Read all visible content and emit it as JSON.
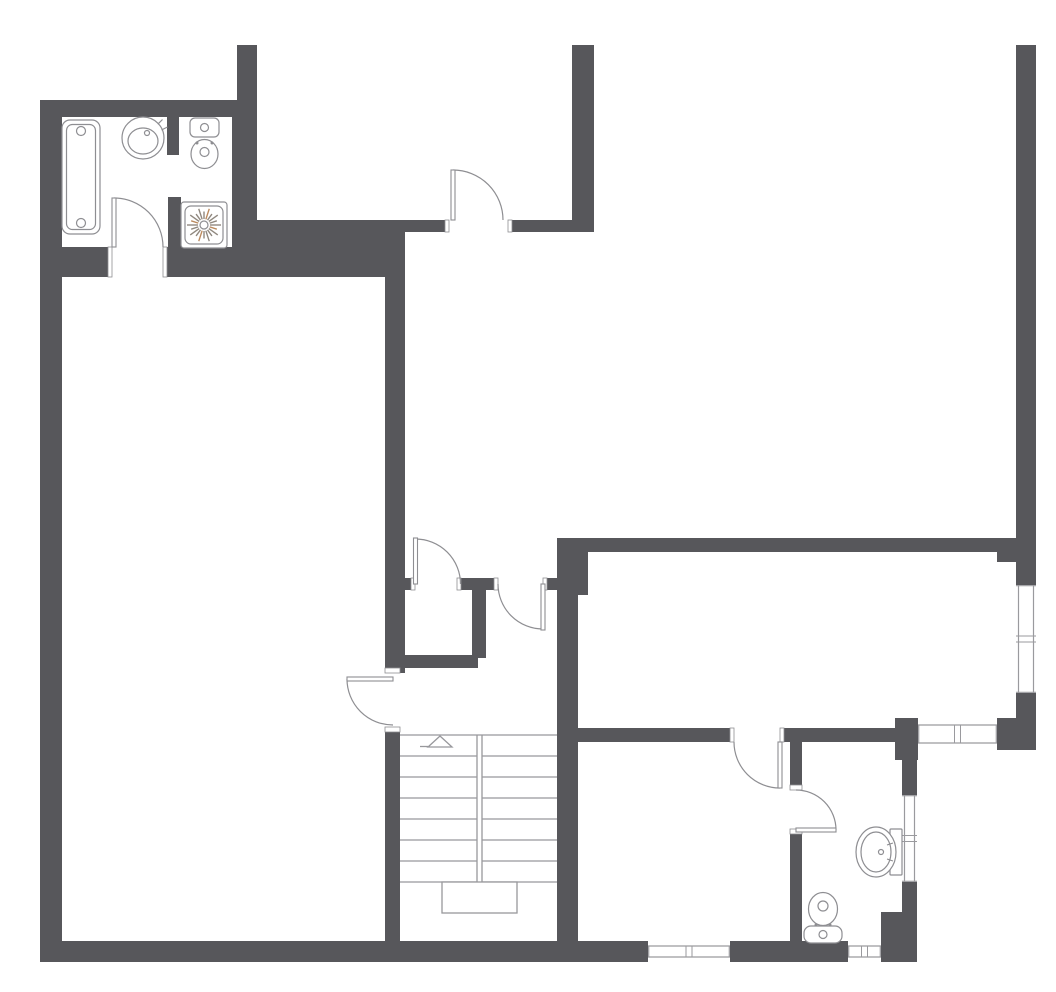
{
  "meta": {
    "type": "architectural-floor-plan",
    "canvas": {
      "w": 1056,
      "h": 992
    },
    "visible_text": []
  },
  "colors": {
    "background": "#ffffff",
    "wall": "#57575b",
    "fixture_stroke": "#8e8e92",
    "stair_stroke": "#98989c",
    "window_frame": "#9a9a9e",
    "shower_ray": "#90887f",
    "shower_ray_warm": "#bb8a5e"
  },
  "walls": [
    [
      40,
      100,
      22,
      858
    ],
    [
      40,
      100,
      217,
      17
    ],
    [
      237,
      45,
      20,
      72
    ],
    [
      232,
      117,
      25,
      160
    ],
    [
      167,
      117,
      12,
      38
    ],
    [
      168,
      197,
      13,
      53
    ],
    [
      40,
      247,
      72,
      30
    ],
    [
      163,
      247,
      69,
      30
    ],
    [
      257,
      220,
      148,
      57
    ],
    [
      405,
      220,
      44,
      12
    ],
    [
      508,
      220,
      64,
      12
    ],
    [
      572,
      45,
      22,
      187
    ],
    [
      385,
      220,
      20,
      453
    ],
    [
      385,
      732,
      15,
      209
    ],
    [
      398,
      578,
      17,
      12
    ],
    [
      461,
      578,
      37,
      12
    ],
    [
      543,
      578,
      14,
      12
    ],
    [
      472,
      590,
      14,
      68
    ],
    [
      398,
      655,
      80,
      13
    ],
    [
      557,
      538,
      21,
      403
    ],
    [
      578,
      552,
      10,
      43
    ],
    [
      563,
      538,
      453,
      14
    ],
    [
      1016,
      45,
      20,
      540
    ],
    [
      997,
      548,
      19,
      14
    ],
    [
      1016,
      693,
      20,
      25
    ],
    [
      997,
      718,
      39,
      32
    ],
    [
      557,
      728,
      177,
      14
    ],
    [
      780,
      728,
      115,
      14
    ],
    [
      895,
      718,
      23,
      42
    ],
    [
      790,
      742,
      12,
      48
    ],
    [
      790,
      829,
      12,
      112
    ],
    [
      902,
      760,
      15,
      35
    ],
    [
      902,
      882,
      15,
      30
    ],
    [
      881,
      912,
      36,
      50
    ],
    [
      40,
      941,
      608,
      21
    ],
    [
      730,
      941,
      118,
      21
    ]
  ],
  "windows": [
    {
      "id": "window-right-wall",
      "x": 1016,
      "y": 585,
      "w": 20,
      "h": 108,
      "orient": "v"
    },
    {
      "id": "window-right-room-bottom",
      "x": 918,
      "y": 722,
      "w": 79,
      "h": 24,
      "orient": "h"
    },
    {
      "id": "window-bathroom-right",
      "x": 902,
      "y": 795,
      "w": 15,
      "h": 87,
      "orient": "v"
    },
    {
      "id": "window-bathroom-bottom",
      "x": 848,
      "y": 943,
      "w": 33,
      "h": 17,
      "orient": "h"
    },
    {
      "id": "window-bedroom-bottom",
      "x": 648,
      "y": 943,
      "w": 82,
      "h": 17,
      "orient": "h"
    }
  ],
  "doors": [
    {
      "id": "door-bathroom-top-left",
      "leaf": [
        112,
        198,
        4,
        49
      ],
      "arc": "M114,198 A49,49 0 0 1 163,247",
      "jambs": [
        [
          108,
          247,
          4,
          30
        ],
        [
          163,
          247,
          4,
          30
        ]
      ]
    },
    {
      "id": "door-top-middle-room",
      "leaf": [
        451,
        170,
        4,
        50
      ],
      "arc": "M453,170 A50,50 0 0 1 503,220",
      "jambs": [
        [
          445,
          220,
          4,
          12
        ],
        [
          508,
          220,
          4,
          12
        ]
      ]
    },
    {
      "id": "door-closet",
      "leaf": [
        413.5,
        538,
        4,
        46
      ],
      "arc": "M415.5,539 A45,45 0 0 1 460.5,584",
      "jambs": [
        [
          411,
          578,
          4,
          12
        ],
        [
          457,
          578,
          4,
          12
        ]
      ]
    },
    {
      "id": "door-stair-passage",
      "leaf": [
        541,
        584,
        4,
        46
      ],
      "arc": "M498,584 A45,45 0 0 0 543,629",
      "jambs": [
        [
          494,
          578,
          4,
          12
        ],
        [
          543,
          578,
          4,
          12
        ]
      ]
    },
    {
      "id": "door-stairs-room",
      "leaf": [
        347,
        677,
        46,
        4
      ],
      "arc": "M347,679 A46,46 0 0 0 393,725",
      "jambs": [
        [
          385,
          668,
          15,
          5
        ],
        [
          385,
          727,
          15,
          5
        ]
      ]
    },
    {
      "id": "door-bedroom",
      "leaf": [
        778,
        742,
        4,
        46
      ],
      "arc": "M734,742 A46,46 0 0 0 780,788",
      "jambs": [
        [
          730,
          728,
          4,
          14
        ],
        [
          780,
          728,
          4,
          14
        ]
      ]
    },
    {
      "id": "door-bathroom-bottom",
      "leaf": [
        796,
        828,
        40,
        4
      ],
      "arc": "M796,790 A40,40 0 0 1 836,830",
      "jambs": [
        [
          790,
          785,
          12,
          5
        ],
        [
          790,
          829,
          12,
          5
        ]
      ]
    }
  ],
  "stairs": {
    "x_left": 400,
    "x_mid1": 477,
    "x_mid2": 482,
    "x_right": 557,
    "y_top": 735,
    "y_bottom": 882,
    "treads": [
      756,
      777,
      798,
      819,
      840,
      861,
      882
    ],
    "landing": {
      "x": 442,
      "y": 882,
      "w": 75,
      "h": 31
    },
    "arrow": {
      "points": "428,747 452,747 440,736",
      "tail": [
        420,
        746.5,
        428,
        746.5
      ]
    }
  },
  "fixtures": [
    {
      "id": "bathtub",
      "type": "bathtub",
      "x": 62,
      "y": 120,
      "w": 38,
      "h": 114,
      "circles": [
        [
          81,
          131,
          4.5
        ],
        [
          81,
          223,
          4.5
        ]
      ]
    },
    {
      "id": "sink-round-top-left",
      "type": "sink-round",
      "cx": 143,
      "cy": 138,
      "r": 21,
      "inner": [
        143,
        141,
        15,
        13
      ],
      "drain": [
        147,
        133,
        2.5
      ],
      "taps": [
        [
          157.8,
          124.2,
          162.5,
          119.5
        ],
        [
          161.5,
          130,
          167.5,
          127
        ]
      ]
    },
    {
      "id": "toilet-top-left",
      "type": "toilet",
      "tank": [
        190,
        118,
        29,
        19,
        5
      ],
      "tank_circle": [
        204.5,
        127.5,
        4
      ],
      "dots": [
        [
          197,
          143
        ],
        [
          212,
          143
        ]
      ],
      "bowl": [
        204.5,
        154,
        13.5,
        14.5
      ],
      "bowl_circle": [
        204.5,
        152,
        4.5
      ]
    },
    {
      "id": "shower-tray",
      "type": "shower",
      "x": 181,
      "y": 202,
      "s": 46,
      "cx": 204,
      "cy": 225,
      "rays": 20
    },
    {
      "id": "toilet-bottom-right",
      "type": "toilet",
      "tank": [
        804,
        926,
        38,
        17,
        7
      ],
      "tank_circle": [
        823,
        934.5,
        4
      ],
      "dots": [
        [
          816,
          925
        ],
        [
          830,
          925
        ]
      ],
      "bowl": [
        823,
        909,
        14.5,
        16.5
      ],
      "bowl_circle": [
        823,
        906,
        5
      ]
    },
    {
      "id": "sink-oval-bottom-right",
      "type": "sink-oval",
      "mount": [
        890,
        829,
        12,
        46
      ],
      "outer": [
        876,
        852,
        20,
        25
      ],
      "inner": [
        876,
        852,
        15,
        20
      ],
      "tap": [
        881,
        852,
        2.5
      ],
      "ticks": [
        [
          887,
          845,
          893,
          843
        ],
        [
          887,
          859,
          893,
          861
        ]
      ]
    }
  ]
}
